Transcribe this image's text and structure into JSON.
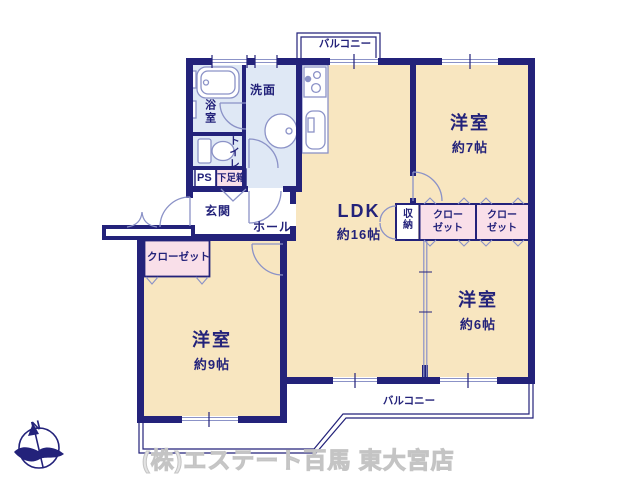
{
  "plan": {
    "balcony_top": "バルコニー",
    "balcony_bottom": "バルコニー",
    "rooms": {
      "ldk": {
        "name": "LDK",
        "size": "約16帖"
      },
      "western_7": {
        "name": "洋室",
        "size": "約7帖"
      },
      "western_6": {
        "name": "洋室",
        "size": "約6帖"
      },
      "western_9": {
        "name": "洋室",
        "size": "約9帖"
      },
      "bath": "浴室",
      "washroom": "洗面",
      "toilet": "トイレ",
      "pipe_space": "PS",
      "shoe_box": "下足箱",
      "entrance": "玄関",
      "hall": "ホール",
      "storage": "収納",
      "closet_right_1": "クローゼット",
      "closet_right_2": "クローゼット",
      "closet_left": "クローゼット"
    },
    "compass": {
      "north_label": "N"
    }
  },
  "watermark": "(株)エステート百馬 東大宮店",
  "colors": {
    "wall": "#23227a",
    "floor_cream": "#f8e6c0",
    "floor_blue": "#dfe8f5",
    "closet_pink": "#f9dfe9",
    "thin_line": "#8b92c7",
    "text": "#23227a",
    "watermark_gray": "#c4c4c4"
  }
}
